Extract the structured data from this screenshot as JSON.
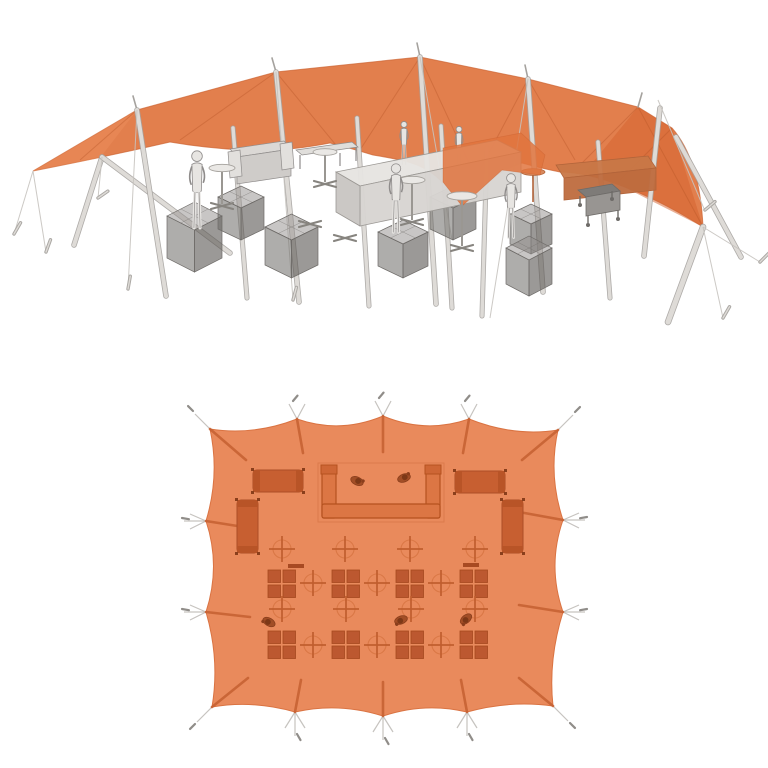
{
  "scene": {
    "description": "Orange stretch tent event setup rendering: perspective view above, top-down plan view below",
    "background": "#ffffff"
  },
  "colors": {
    "canopy": "#E0743E",
    "canopy_edge": "#CC6230",
    "canopy_shade": "#D4622E",
    "canopy_highlight": "#F09560",
    "seam": "#B35123",
    "plan_fabric": "#E98A5C",
    "plan_fabric_edge": "#DA7342",
    "plan_furniture": "#C75F31",
    "plan_furniture_dark": "#B5521F",
    "plan_ottoman": "#BC5830",
    "plan_ottoman_edge": "#A5491F",
    "plan_cross": "#C05E2E",
    "plan_circle": "#D4713F",
    "plan_fold": "#C45F30",
    "plan_person": "#A24E26",
    "plan_person_head": "#7C3817",
    "pole_outer": "#A5A29E",
    "pole_inner": "#DEDBD7",
    "rope": "#C6C3BF",
    "peg": "#ABA8A4",
    "gray_light": "#E7E5E2",
    "gray_mid": "#D0CDCA",
    "gray_dark": "#8F8C8B",
    "cube_top": "rgba(145,142,139,0.50)",
    "cube_left": "rgba(108,105,102,0.55)",
    "cube_right": "rgba(88,85,82,0.60)",
    "cube_edge": "#6E6B68",
    "tinted_sofa": "#C87747",
    "tinted_sofa_front": "#BE6C3E",
    "tinted_edge": "#B2643A"
  },
  "perspective": {
    "canopy_path": "M33,171 L137,110 L276,72 L420,57 L528,79 L638,107 L672,128 Q700,160 703,227 Q660,200 622,186 Q585,172 560,172 Q540,168 522,163 Q500,170 480,188 Q460,208 440,180 Q425,165 400,160 Q386,157 373,155 Q350,148 330,143 Q285,152 243,150 Q205,148 170,142 Q100,158 33,171 Z",
    "shades": [
      {
        "pts": [
          [
            638,
            107
          ],
          [
            672,
            128
          ],
          [
            703,
            227
          ],
          [
            622,
            186
          ],
          [
            585,
            172
          ]
        ],
        "fill": "#D4622E",
        "op": 0.5
      },
      {
        "pts": [
          [
            33,
            171
          ],
          [
            137,
            110
          ],
          [
            100,
            158
          ]
        ],
        "fill": "#F09560",
        "op": 0.35
      },
      {
        "pts": [
          [
            420,
            57
          ],
          [
            528,
            79
          ],
          [
            480,
            120
          ]
        ],
        "fill": "#E8straight",
        "op": 0
      }
    ],
    "seams": [
      [
        276,
        72,
        180,
        140
      ],
      [
        276,
        72,
        340,
        150
      ],
      [
        420,
        57,
        360,
        150
      ],
      [
        420,
        57,
        470,
        165
      ],
      [
        528,
        79,
        480,
        170
      ],
      [
        528,
        79,
        575,
        160
      ],
      [
        137,
        110,
        80,
        160
      ],
      [
        638,
        107,
        580,
        165
      ],
      [
        672,
        128,
        620,
        180
      ],
      [
        638,
        107,
        703,
        227
      ]
    ],
    "peak_stubs": [
      [
        137,
        110,
        133,
        96
      ],
      [
        276,
        72,
        272,
        58
      ],
      [
        420,
        57,
        417,
        43
      ],
      [
        528,
        79,
        525,
        65
      ],
      [
        638,
        107,
        642,
        93
      ]
    ],
    "poles": [
      [
        102,
        157,
        74,
        245,
        4
      ],
      [
        102,
        157,
        230,
        253,
        4
      ],
      [
        137,
        110,
        166,
        296,
        4
      ],
      [
        233,
        128,
        247,
        298,
        3.5
      ],
      [
        276,
        72,
        299,
        302,
        4
      ],
      [
        357,
        118,
        369,
        306,
        3.5
      ],
      [
        420,
        57,
        436,
        304,
        4
      ],
      [
        441,
        126,
        452,
        308,
        3.5
      ],
      [
        487,
        148,
        482,
        316,
        3.5
      ],
      [
        528,
        79,
        543,
        292,
        4
      ],
      [
        598,
        142,
        610,
        298,
        3.5
      ],
      [
        660,
        108,
        644,
        256,
        4
      ],
      [
        703,
        227,
        668,
        322,
        5
      ],
      [
        676,
        137,
        741,
        257,
        4
      ]
    ],
    "ropes": [
      [
        33,
        171,
        14,
        234
      ],
      [
        33,
        171,
        46,
        252
      ],
      [
        137,
        110,
        128,
        289
      ],
      [
        276,
        72,
        293,
        300
      ],
      [
        528,
        79,
        490,
        318
      ],
      [
        420,
        57,
        452,
        240
      ],
      [
        703,
        227,
        723,
        318
      ],
      [
        703,
        227,
        760,
        262
      ],
      [
        658,
        100,
        705,
        211
      ],
      [
        102,
        157,
        98,
        198
      ]
    ],
    "pegs": [
      [
        14,
        234,
        13,
        -60
      ],
      [
        46,
        252,
        13,
        -70
      ],
      [
        128,
        289,
        13,
        -80
      ],
      [
        293,
        300,
        13,
        -75
      ],
      [
        98,
        198,
        12,
        -35
      ],
      [
        705,
        210,
        13,
        -40
      ],
      [
        723,
        318,
        13,
        -60
      ],
      [
        760,
        262,
        13,
        -45
      ]
    ],
    "back_sofa": [
      {
        "pts": [
          [
            556,
            165
          ],
          [
            648,
            156
          ],
          [
            656,
            168
          ],
          [
            564,
            178
          ]
        ],
        "fill": "#C87747"
      },
      {
        "pts": [
          [
            564,
            178
          ],
          [
            656,
            168
          ],
          [
            656,
            190
          ],
          [
            564,
            200
          ]
        ],
        "fill": "#BE6C3E"
      }
    ],
    "trolley": {
      "faces": [
        {
          "pts": [
            [
              578,
              190
            ],
            [
              612,
              184
            ],
            [
              620,
              191
            ],
            [
              586,
              197
            ]
          ],
          "fill": "#7E7B78"
        },
        {
          "pts": [
            [
              586,
              197
            ],
            [
              620,
              191
            ],
            [
              620,
              210
            ],
            [
              586,
              216
            ]
          ],
          "fill": "#989592"
        }
      ],
      "legs": [
        [
          588,
          216,
          588,
          223
        ],
        [
          618,
          210,
          618,
          217
        ],
        [
          580,
          196,
          580,
          203
        ],
        [
          612,
          191,
          612,
          197
        ]
      ],
      "wheels": [
        [
          588,
          225
        ],
        [
          618,
          219
        ],
        [
          580,
          205
        ],
        [
          612,
          199
        ]
      ]
    },
    "left_sofa": [
      {
        "pts": [
          [
            230,
            149
          ],
          [
            284,
            141
          ],
          [
            291,
            149
          ],
          [
            237,
            157
          ]
        ],
        "fill": "#DBD8D5"
      },
      {
        "pts": [
          [
            237,
            157
          ],
          [
            291,
            149
          ],
          [
            291,
            176
          ],
          [
            237,
            184
          ]
        ],
        "fill": "#CFCCC9"
      },
      {
        "pts": [
          [
            228,
            152
          ],
          [
            240,
            150
          ],
          [
            242,
            176
          ],
          [
            230,
            178
          ]
        ],
        "fill": "#E2E0DD"
      },
      {
        "pts": [
          [
            280,
            144
          ],
          [
            292,
            142
          ],
          [
            294,
            168
          ],
          [
            282,
            170
          ]
        ],
        "fill": "#E2E0DD"
      }
    ],
    "bench": {
      "top": [
        [
          296,
          150
        ],
        [
          352,
          142
        ],
        [
          358,
          147
        ],
        [
          302,
          155
        ]
      ],
      "legs": [
        [
          300,
          155,
          300,
          169
        ],
        [
          356,
          147,
          356,
          161
        ],
        [
          340,
          153,
          340,
          166
        ]
      ]
    },
    "cubes": [
      [
        167,
        202,
        55,
        14,
        42
      ],
      [
        218,
        186,
        46,
        11,
        32
      ],
      [
        265,
        214,
        53,
        13,
        38
      ],
      [
        378,
        220,
        50,
        12,
        34
      ],
      [
        430,
        186,
        46,
        11,
        32
      ],
      [
        510,
        204,
        42,
        10,
        30
      ],
      [
        506,
        236,
        46,
        12,
        36
      ]
    ],
    "bar": [
      {
        "pts": [
          [
            336,
            172
          ],
          [
            497,
            140
          ],
          [
            521,
            152
          ],
          [
            360,
            186
          ]
        ],
        "fill": "#E6E4E1"
      },
      {
        "pts": [
          [
            360,
            186
          ],
          [
            521,
            152
          ],
          [
            521,
            192
          ],
          [
            360,
            226
          ]
        ],
        "fill": "#D7D4D1"
      },
      {
        "pts": [
          [
            336,
            172
          ],
          [
            360,
            186
          ],
          [
            360,
            226
          ],
          [
            336,
            212
          ]
        ],
        "fill": "#C9C6C3"
      }
    ],
    "drape": [
      [
        443,
        148
      ],
      [
        521,
        133
      ],
      [
        545,
        155
      ],
      [
        540,
        175
      ],
      [
        502,
        170
      ],
      [
        480,
        190
      ],
      [
        462,
        206
      ],
      [
        443,
        182
      ]
    ],
    "tinted_table": {
      "x": 533,
      "y": 172,
      "rx": 12,
      "h": 30
    },
    "tables": [
      {
        "x": 222,
        "y": 168,
        "rx": 13,
        "h": 36
      },
      {
        "x": 325,
        "y": 152,
        "rx": 12,
        "h": 30
      },
      {
        "x": 412,
        "y": 180,
        "rx": 13,
        "h": 40
      },
      {
        "x": 462,
        "y": 196,
        "rx": 15,
        "h": 50
      }
    ],
    "floor_crosses": [
      [
        310,
        222
      ],
      [
        345,
        236
      ]
    ],
    "bartenders": [
      {
        "x": 404,
        "y": 121,
        "h": 46
      },
      {
        "x": 459,
        "y": 126,
        "h": 44
      }
    ],
    "people": [
      {
        "x": 197,
        "y": 150,
        "h": 82
      },
      {
        "x": 396,
        "y": 163,
        "h": 73
      },
      {
        "x": 511,
        "y": 173,
        "h": 68
      }
    ]
  },
  "plan": {
    "fabric_path": "M210,429 Q253,436 297,419 Q340,434 383,416 Q426,434 469,419 Q514,437 558,430 Q548,475 563,520 Q547,566 563,612 Q548,660 553,706 Q510,700 467,712 Q425,702 383,716 Q339,702 295,712 Q253,700 212,707 Q220,660 206,612 Q221,566 206,521 Q220,475 210,429 Z",
    "folds": [
      [
        210,
        429,
        246,
        460
      ],
      [
        558,
        430,
        522,
        460
      ],
      [
        553,
        706,
        519,
        678
      ],
      [
        212,
        707,
        248,
        678
      ],
      [
        297,
        419,
        303,
        453
      ],
      [
        383,
        416,
        383,
        452
      ],
      [
        469,
        419,
        463,
        453
      ],
      [
        295,
        712,
        301,
        680
      ],
      [
        383,
        716,
        383,
        682
      ],
      [
        467,
        712,
        461,
        680
      ],
      [
        206,
        521,
        250,
        528
      ],
      [
        206,
        612,
        250,
        617
      ],
      [
        563,
        520,
        519,
        512
      ],
      [
        563,
        612,
        519,
        605
      ]
    ],
    "guys": [
      [
        297,
        419,
        289,
        404
      ],
      [
        297,
        419,
        305,
        404
      ],
      [
        383,
        416,
        375,
        401
      ],
      [
        383,
        416,
        391,
        401
      ],
      [
        469,
        419,
        461,
        404
      ],
      [
        469,
        419,
        477,
        404
      ],
      [
        295,
        712,
        285,
        728
      ],
      [
        295,
        712,
        305,
        728
      ],
      [
        295,
        712,
        295,
        736
      ],
      [
        383,
        716,
        373,
        732
      ],
      [
        383,
        716,
        393,
        732
      ],
      [
        383,
        716,
        383,
        740
      ],
      [
        467,
        712,
        457,
        728
      ],
      [
        467,
        712,
        477,
        728
      ],
      [
        467,
        712,
        467,
        736
      ],
      [
        206,
        521,
        190,
        514
      ],
      [
        206,
        521,
        190,
        529
      ],
      [
        206,
        521,
        184,
        521
      ],
      [
        206,
        612,
        190,
        605
      ],
      [
        206,
        612,
        190,
        620
      ],
      [
        206,
        612,
        184,
        612
      ],
      [
        563,
        520,
        579,
        513
      ],
      [
        563,
        520,
        579,
        528
      ],
      [
        563,
        520,
        585,
        520
      ],
      [
        563,
        612,
        579,
        605
      ],
      [
        563,
        612,
        579,
        620
      ],
      [
        563,
        612,
        585,
        612
      ],
      [
        210,
        429,
        195,
        414
      ],
      [
        558,
        430,
        573,
        415
      ],
      [
        553,
        706,
        568,
        721
      ],
      [
        212,
        707,
        197,
        722
      ]
    ],
    "pegs": [
      [
        293,
        401,
        7,
        -50
      ],
      [
        379,
        398,
        7,
        -50
      ],
      [
        465,
        401,
        7,
        -50
      ],
      [
        297,
        734,
        7,
        60
      ],
      [
        385,
        738,
        7,
        60
      ],
      [
        469,
        734,
        7,
        60
      ],
      [
        182,
        518,
        7,
        10
      ],
      [
        182,
        609,
        7,
        10
      ],
      [
        587,
        517,
        7,
        170
      ],
      [
        587,
        609,
        7,
        170
      ],
      [
        193,
        411,
        7,
        -135
      ],
      [
        575,
        412,
        7,
        -45
      ],
      [
        570,
        723,
        7,
        45
      ],
      [
        195,
        724,
        7,
        135
      ]
    ],
    "bar": {
      "outline": [
        318,
        463,
        126,
        59
      ],
      "parts": [
        [
          322,
          467,
          14,
          51
        ],
        [
          426,
          467,
          14,
          51
        ],
        [
          322,
          504,
          118,
          14
        ]
      ],
      "caps": [
        [
          321,
          465,
          16,
          9
        ],
        [
          425,
          465,
          16,
          9
        ]
      ]
    },
    "sofas_h": [
      {
        "x": 253,
        "y": 470,
        "w": 50,
        "h": 22
      },
      {
        "x": 455,
        "y": 471,
        "w": 50,
        "h": 22
      }
    ],
    "sofas_v": [
      {
        "x": 237,
        "y": 500,
        "w": 21,
        "h": 53
      },
      {
        "x": 502,
        "y": 500,
        "w": 21,
        "h": 53
      }
    ],
    "ottomans": [
      [
        268,
        570
      ],
      [
        332,
        570
      ],
      [
        396,
        570
      ],
      [
        460,
        570
      ],
      [
        268,
        631
      ],
      [
        332,
        631
      ],
      [
        396,
        631
      ],
      [
        460,
        631
      ]
    ],
    "shelves": [
      [
        288,
        564,
        16,
        4
      ],
      [
        463,
        563,
        16,
        4
      ]
    ],
    "crosses": [
      [
        282,
        549
      ],
      [
        345,
        549
      ],
      [
        410,
        549
      ],
      [
        475,
        549
      ],
      [
        313,
        583
      ],
      [
        377,
        583
      ],
      [
        441,
        583
      ],
      [
        282,
        609
      ],
      [
        346,
        609
      ],
      [
        411,
        609
      ],
      [
        475,
        609
      ],
      [
        313,
        645
      ],
      [
        377,
        645
      ],
      [
        441,
        645
      ]
    ],
    "bar_people": [
      [
        357,
        481,
        25
      ],
      [
        404,
        478,
        -20
      ]
    ],
    "floor_people": [
      [
        269,
        622,
        210
      ],
      [
        401,
        620,
        160
      ],
      [
        466,
        619,
        140
      ]
    ]
  }
}
